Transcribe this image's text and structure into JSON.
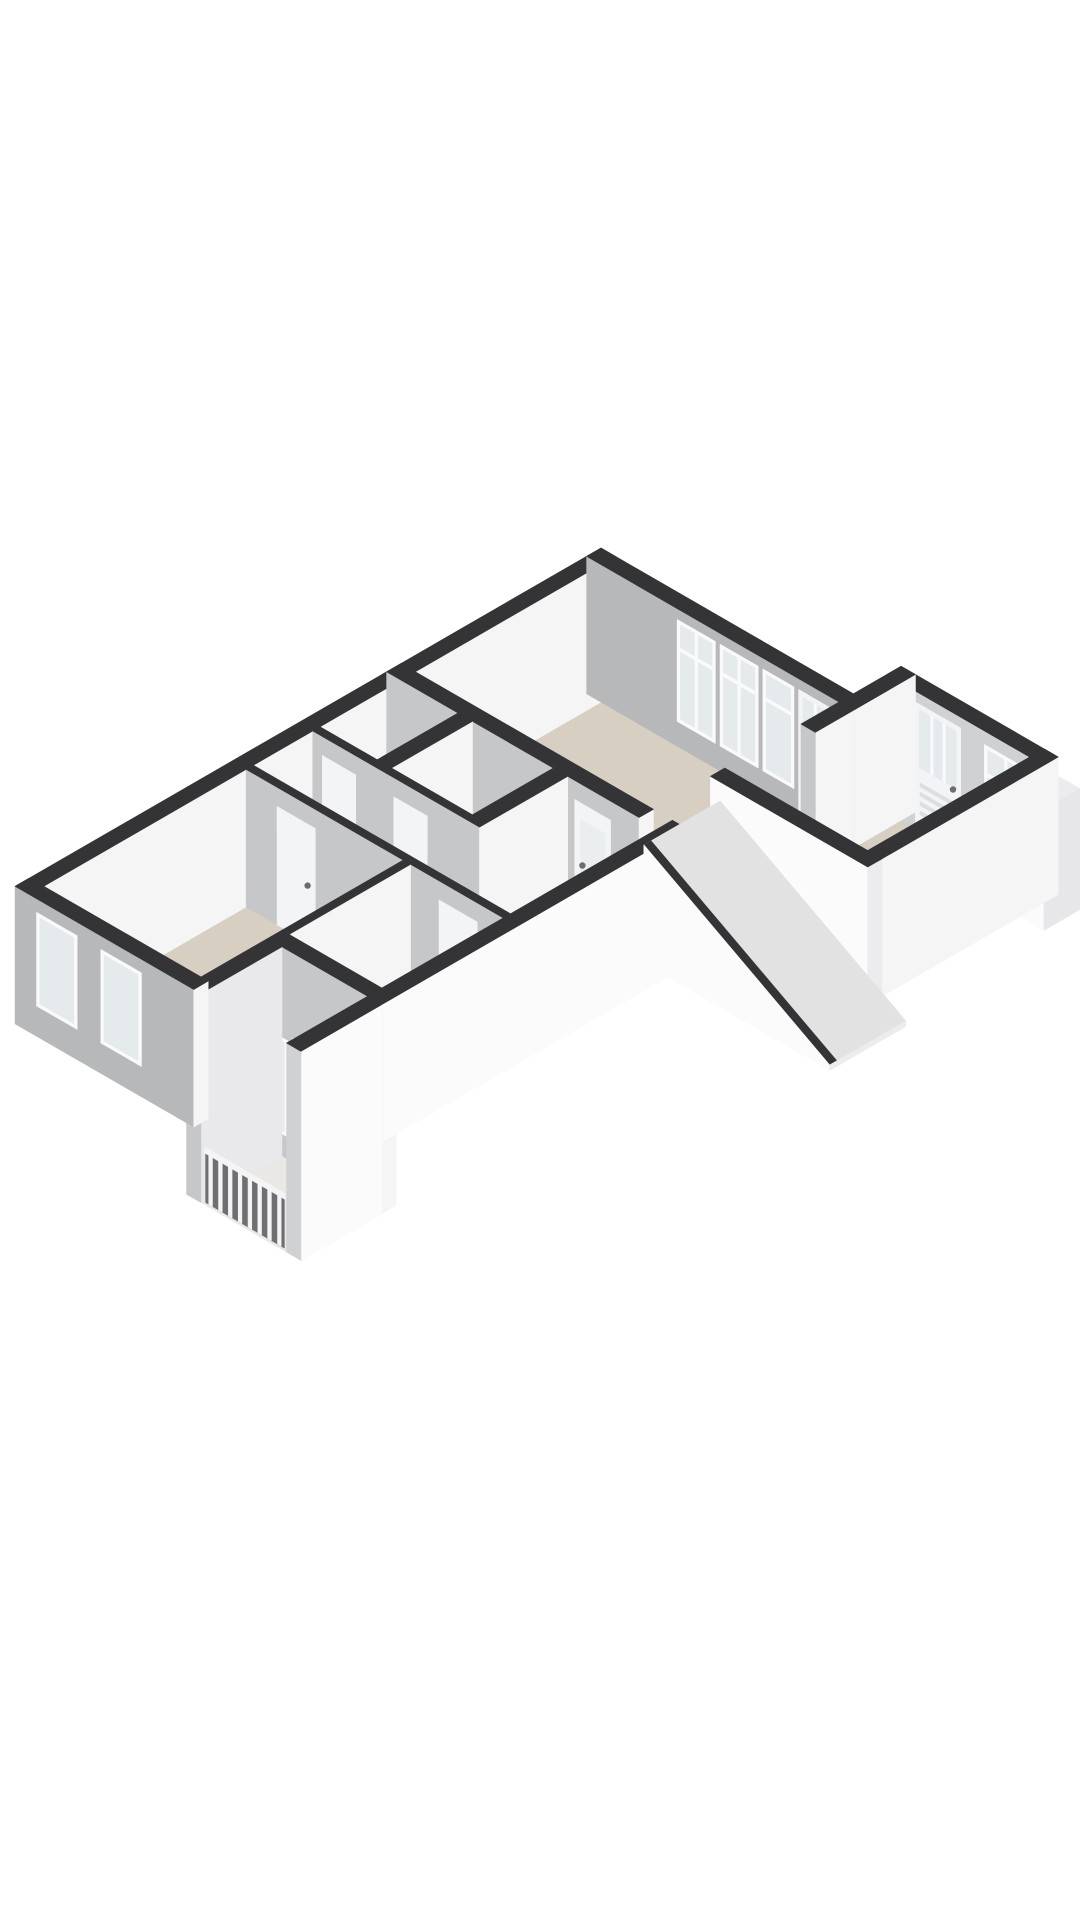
{
  "canvas": {
    "width": 1080,
    "height": 1920,
    "background": "#ffffff"
  },
  "projection": {
    "ox": 601,
    "oy": 548,
    "k": 55,
    "wallHeight": 2.5
  },
  "palette": {
    "top": "#343436",
    "white": "#f5f5f6",
    "whiteBright": "#fbfbfc",
    "grayFace": "#b7b8ba",
    "grayMid": "#c6c7c9",
    "grayLight": "#d0d1d3",
    "capLight": "#ececee",
    "floorMain": "#d7cfc1",
    "floorHall": "#e7e5e1",
    "floorWet": "#edece9",
    "floorBalcony": "#e9e8e4",
    "pane": "#e5eaed",
    "paneFrost": "#ebeef0",
    "frame": "#fafafa",
    "leaf": "#f3f4f5",
    "railBack": "#6f6f73",
    "railWhite": "#f4f4f5",
    "red": "#c0392b",
    "dotC": "#4a4a4c",
    "stairTop": "#e2e2e3",
    "louver": "#dddee0",
    "handleC": "#6a6d70",
    "boxTop": "#ece5da"
  },
  "items": [
    {
      "name": "floor-living",
      "type": "floor",
      "pts": [
        [
          0.15,
          0.15
        ],
        [
          5.3,
          0.15
        ],
        [
          5.3,
          4.2
        ],
        [
          0.15,
          4.2
        ]
      ],
      "fill": "floorMain"
    },
    {
      "name": "floor-entry",
      "type": "floor",
      "pts": [
        [
          5.3,
          -0.7
        ],
        [
          8.3,
          -0.7
        ],
        [
          8.3,
          2.7
        ],
        [
          5.3,
          2.7
        ]
      ],
      "fill": "floorMain"
    },
    {
      "name": "floor-hall",
      "type": "floor",
      "pts": [
        [
          0.3,
          4.5
        ],
        [
          5.7,
          4.5
        ],
        [
          5.7,
          7.6
        ],
        [
          0.3,
          7.6
        ]
      ],
      "fill": "floorHall"
    },
    {
      "name": "floor-wc",
      "type": "floor",
      "pts": [
        [
          0.3,
          4.5
        ],
        [
          1.5,
          4.5
        ],
        [
          1.5,
          6.2
        ],
        [
          0.3,
          6.2
        ]
      ],
      "fill": "floorWet"
    },
    {
      "name": "floor-bathroom",
      "type": "floor",
      "pts": [
        [
          1.8,
          4.5
        ],
        [
          3.5,
          4.5
        ],
        [
          3.5,
          6.2
        ],
        [
          1.8,
          6.2
        ]
      ],
      "fill": "floorWet"
    },
    {
      "name": "floor-bedroom-1",
      "type": "floor",
      "pts": [
        [
          0.3,
          7.75
        ],
        [
          3.6,
          7.75
        ],
        [
          3.6,
          12.0
        ],
        [
          0.3,
          12.0
        ]
      ],
      "fill": "floorMain"
    },
    {
      "name": "floor-bedroom-2",
      "type": "floor",
      "pts": [
        [
          3.75,
          7.75
        ],
        [
          5.7,
          7.75
        ],
        [
          5.7,
          10.3
        ],
        [
          3.75,
          10.3
        ]
      ],
      "fill": "floorMain"
    },
    {
      "name": "floor-porch",
      "type": "floor",
      "h": -1.3,
      "pts": [
        [
          3.9,
          10.6
        ],
        [
          6.0,
          10.6
        ],
        [
          6.0,
          12.3
        ],
        [
          3.9,
          12.3
        ]
      ],
      "fill": "floorBalcony"
    },
    {
      "name": "wall-living-west",
      "type": "wall",
      "axis": "v",
      "a": 0,
      "b": 4.2,
      "p": 0,
      "th": 0.3,
      "face": "white",
      "cap": "grayMid"
    },
    {
      "name": "wall-living-north-windows",
      "type": "wall",
      "axis": "u",
      "a": 0,
      "b": 5.3,
      "p": 0,
      "th": 0.3,
      "face": "grayFace",
      "cap": "white",
      "wins": [
        {
          "t1": 1.9,
          "t2": 2.7,
          "z1": 0.45,
          "z2": 2.3,
          "mull": 1,
          "transom": 1.75
        },
        {
          "t1": 2.8,
          "t2": 3.6,
          "z1": 0.45,
          "z2": 2.3,
          "mull": 1,
          "transom": 1.75
        },
        {
          "t1": 3.7,
          "t2": 4.35,
          "z1": 0.45,
          "z2": 2.3,
          "mull": 0,
          "transom": 1.75
        }
      ],
      "doors": [
        {
          "t1": 4.45,
          "t2": 5.15,
          "z2": 2.3,
          "glass": {
            "z1": 0.35,
            "z2": 2.2,
            "bars": 1
          },
          "handle": "l"
        }
      ]
    },
    {
      "name": "wall-entry-north-frontdoor",
      "type": "wall",
      "axis": "u",
      "a": 5.3,
      "b": 8.6,
      "p": -1.0,
      "th": 0.3,
      "face": "grayLight",
      "cap": "white",
      "doors": [
        {
          "t1": 5.9,
          "t2": 6.85,
          "z2": 2.3,
          "glass": {
            "z1": 1.15,
            "z2": 2.2,
            "bars": 2
          },
          "louver": true,
          "handle": "r"
        }
      ],
      "wins": [
        {
          "t1": 7.35,
          "t2": 8.25,
          "z1": 0.35,
          "z2": 2.25,
          "mull": 1,
          "transom": 1.7
        }
      ]
    },
    {
      "name": "wall-entry-step",
      "type": "wall",
      "axis": "v",
      "a": -1.0,
      "b": 0.3,
      "p": 5.3,
      "th": 0.3,
      "face": "white",
      "cap": "grayMid"
    },
    {
      "name": "wall-living-east-partial",
      "type": "wall",
      "axis": "v",
      "a": 0.3,
      "b": 1.1,
      "p": 5.3,
      "th": 0.3,
      "face": "white",
      "cap": "grayMid"
    },
    {
      "name": "meter-cupboard",
      "type": "box",
      "u1": 8.6,
      "v1": -0.95,
      "u2": 9.1,
      "v2": -0.2,
      "h": 2.2,
      "top": "capLight",
      "faceV": "whiteBright",
      "faceU": "#e7e7e9"
    },
    {
      "name": "meter-cupboard-dot-1",
      "type": "dot",
      "at": [
        8.78,
        -0.2,
        1.45
      ],
      "r": 3.2,
      "fill": "dotC"
    },
    {
      "name": "meter-cupboard-dot-2",
      "type": "dot",
      "at": [
        8.95,
        -0.2,
        1.45
      ],
      "r": 3.2,
      "fill": "dotC"
    },
    {
      "name": "wall-entry-east",
      "type": "wall",
      "axis": "v",
      "a": -1.0,
      "b": 3.0,
      "p": 8.3,
      "th": 0.3,
      "face": "white",
      "cap": "capLight"
    },
    {
      "name": "stair-step",
      "type": "box",
      "u1": 5.4,
      "v1": 1.0,
      "u2": 6.1,
      "v2": 1.7,
      "h": 0.6,
      "top": "whiteBright",
      "faceV": "white",
      "faceU": "#e9e9eb"
    },
    {
      "name": "stair-landing",
      "type": "box",
      "u1": 5.4,
      "v1": 1.7,
      "u2": 6.5,
      "v2": 2.7,
      "h": 0.3,
      "top": "boxTop",
      "faceV": "white",
      "faceU": "#e9e9eb"
    },
    {
      "name": "wall-lower-northwest",
      "type": "wall",
      "axis": "v",
      "a": 4.2,
      "b": 12.3,
      "p": 0,
      "th": 0.3,
      "face": "white",
      "cap": "grayMid"
    },
    {
      "name": "wall-living-south-frosted-door",
      "type": "wall",
      "axis": "u",
      "a": 0,
      "b": 5.3,
      "p": 4.2,
      "th": 0.3,
      "face": "grayMid",
      "cap": "white",
      "doors": [
        {
          "t1": 3.95,
          "t2": 4.7,
          "z2": 2.15,
          "frost": {
            "z1": 0.9,
            "z2": 1.85
          },
          "handle": "l"
        }
      ]
    },
    {
      "name": "toilet-cistern",
      "type": "box",
      "u1": 0.42,
      "v1": 5.55,
      "u2": 0.6,
      "v2": 6.15,
      "h": 0.82,
      "top": "whiteBright",
      "faceV": "white",
      "faceU": "#e9e9eb"
    },
    {
      "name": "toilet-bowl",
      "type": "box",
      "u1": 0.6,
      "v1": 5.6,
      "u2": 1.0,
      "v2": 6.1,
      "h": 0.45,
      "top": "whiteBright",
      "faceV": "white",
      "faceU": "#e9e9eb"
    },
    {
      "name": "washbasin",
      "type": "box",
      "u1": 1.95,
      "v1": 4.55,
      "u2": 2.35,
      "v2": 4.82,
      "h": 0.85,
      "top": "whiteBright",
      "faceV": "white",
      "faceU": "#e9e9eb"
    },
    {
      "name": "wall-wc-bath-divider",
      "type": "wall",
      "axis": "v",
      "a": 4.5,
      "b": 6.35,
      "p": 1.5,
      "th": 0.3,
      "face": "white",
      "cap": "grayMid"
    },
    {
      "name": "wall-bath-hall-divider",
      "type": "wall",
      "axis": "v",
      "a": 4.5,
      "b": 6.35,
      "p": 3.5,
      "th": 0.3,
      "face": "white",
      "cap": "grayMid"
    },
    {
      "name": "boiler-unit",
      "type": "box",
      "u1": 5.15,
      "v1": 5.2,
      "u2": 5.5,
      "v2": 5.85,
      "h": 1.8,
      "top": "capLight",
      "faceV": "whiteBright",
      "faceU": "#e7e7e9"
    },
    {
      "name": "boiler-decal-1",
      "type": "quad3d",
      "pts": [
        [
          5.2,
          5.85,
          0.4
        ],
        [
          5.3,
          5.85,
          0.4
        ],
        [
          5.3,
          5.85,
          0.15
        ],
        [
          5.2,
          5.85,
          0.15
        ]
      ],
      "fill": "red"
    },
    {
      "name": "boiler-decal-2",
      "type": "quad3d",
      "pts": [
        [
          5.33,
          5.85,
          0.35
        ],
        [
          5.42,
          5.85,
          0.35
        ],
        [
          5.42,
          5.85,
          0.12
        ],
        [
          5.33,
          5.85,
          0.12
        ]
      ],
      "fill": "red"
    },
    {
      "name": "wall-wet-rooms-south",
      "type": "wall",
      "axis": "u",
      "a": 0.3,
      "b": 3.8,
      "p": 6.2,
      "th": 0.15,
      "face": "grayMid",
      "cap": "white",
      "doors": [
        {
          "t1": 0.5,
          "t2": 1.2,
          "z2": 2.15,
          "handle": "r"
        },
        {
          "t1": 2.0,
          "t2": 2.7,
          "z2": 2.15,
          "handle": "r"
        }
      ]
    },
    {
      "name": "wall-hall-south-bedroom-doors",
      "type": "wall",
      "axis": "u",
      "a": 0.3,
      "b": 5.7,
      "p": 7.6,
      "th": 0.15,
      "face": "grayMid",
      "cap": "white",
      "doors": [
        {
          "t1": 0.95,
          "t2": 1.75,
          "z2": 2.15,
          "handle": "r"
        },
        {
          "t1": 4.35,
          "t2": 5.15,
          "z2": 2.15,
          "handle": "l"
        }
      ]
    },
    {
      "name": "wall-bedrooms-divider",
      "type": "wall",
      "axis": "v",
      "a": 7.75,
      "b": 10.3,
      "p": 3.6,
      "th": 0.15,
      "face": "white",
      "cap": "grayMid"
    },
    {
      "name": "wall-porch-french-doors",
      "type": "wall",
      "axis": "u",
      "a": 3.6,
      "b": 6.0,
      "p": 10.3,
      "th": 0.3,
      "face": "grayMid",
      "cap": "white",
      "zBase": -1.3,
      "wins": [
        {
          "t1": 3.8,
          "t2": 4.02,
          "z1": -0.9,
          "z2": 0.85,
          "mull": 0
        }
      ],
      "doors": [
        {
          "t1": 4.12,
          "t2": 4.72,
          "z2": 0.95,
          "zBase": -1.3,
          "glass": {
            "z1": -0.85,
            "z2": 0.85,
            "bars": 0
          },
          "handle": "r"
        },
        {
          "t1": 4.74,
          "t2": 5.34,
          "z2": 0.95,
          "zBase": -1.3,
          "glass": {
            "z1": -0.85,
            "z2": 0.85,
            "bars": 0
          },
          "handle": "l"
        }
      ]
    },
    {
      "name": "wall-porch-west",
      "type": "wall",
      "axis": "v",
      "a": 10.6,
      "b": 12.3,
      "p": 3.6,
      "th": 0.3,
      "face": "#e9e9eb",
      "cap": "grayMid",
      "zBase": -1.3
    },
    {
      "name": "wall-southwest-end-windows",
      "type": "wall",
      "axis": "u",
      "a": 0,
      "b": 3.75,
      "p": 12.0,
      "th": 0.3,
      "face": "grayFace",
      "cap": "white",
      "wins": [
        {
          "t1": 0.45,
          "t2": 1.3,
          "z1": 0.55,
          "z2": 2.25,
          "mull": 0
        },
        {
          "t1": 1.8,
          "t2": 2.65,
          "z1": 0.55,
          "z2": 2.25,
          "mull": 0
        }
      ]
    },
    {
      "name": "wall-lower-southeast-a",
      "type": "wall",
      "axis": "v",
      "a": 4.2,
      "b": 10.6,
      "p": 5.7,
      "th": 0.3,
      "face": "whiteBright",
      "cap": "grayLight"
    },
    {
      "name": "wall-lower-southeast-b",
      "type": "wall",
      "axis": "v",
      "a": 10.6,
      "b": 12.3,
      "p": 5.7,
      "th": 0.3,
      "face": "whiteBright",
      "cap": "grayLight",
      "zBase": -1.3
    },
    {
      "name": "porch-railing",
      "type": "rail",
      "u1": 3.95,
      "u2": 5.6,
      "v": 12.25,
      "z1": -1.3,
      "z2": -0.32,
      "n": 8
    },
    {
      "name": "wall-upper-southeast",
      "type": "wall",
      "axis": "u",
      "a": 5.3,
      "b": 8.6,
      "p": 2.7,
      "th": 0.3,
      "face": "whiteBright",
      "cap": "capLight"
    },
    {
      "name": "stair-slope-top",
      "type": "quad3d",
      "pts": [
        [
          5.5,
          3.0,
          2.15
        ],
        [
          5.5,
          4.6,
          2.15
        ],
        [
          9.4,
          4.6,
          0.1
        ],
        [
          9.4,
          3.0,
          0.1
        ]
      ],
      "fill": "stairTop"
    },
    {
      "name": "stair-slope-edge",
      "type": "quad3d",
      "pts": [
        [
          5.5,
          4.6,
          2.15
        ],
        [
          9.4,
          4.6,
          0.1
        ],
        [
          9.4,
          4.45,
          0.1
        ],
        [
          5.5,
          4.45,
          2.15
        ]
      ],
      "fill": "top"
    },
    {
      "name": "stair-side",
      "type": "quad3d",
      "pts": [
        [
          5.5,
          4.6,
          2.15
        ],
        [
          9.4,
          4.6,
          0.1
        ],
        [
          9.4,
          4.6,
          0.0
        ],
        [
          5.5,
          4.6,
          0.0
        ]
      ],
      "fill": "whiteBright"
    },
    {
      "name": "stair-end",
      "type": "quad3d",
      "pts": [
        [
          9.4,
          3.0,
          0.1
        ],
        [
          9.4,
          4.6,
          0.1
        ],
        [
          9.4,
          4.6,
          0.0
        ],
        [
          9.4,
          3.0,
          0.0
        ]
      ],
      "fill": "capLight"
    }
  ]
}
